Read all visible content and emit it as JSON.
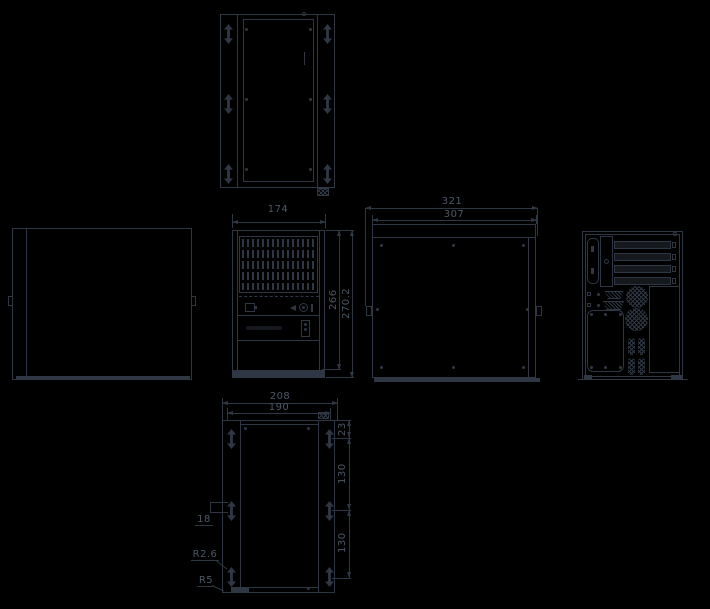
{
  "colors": {
    "background": "#000000",
    "line": "#2e3743",
    "text": "#4d5765"
  },
  "dims": {
    "front_width": "174",
    "front_height": "266",
    "front_height_total": "270.2",
    "depth_total": "321",
    "depth": "307",
    "bottom_width_total": "208",
    "bottom_width": "190",
    "bottom_offset_top": "23",
    "bottom_pitch_upper": "130",
    "bottom_pitch_lower": "130",
    "bottom_slot_width": "18",
    "radius_inner": "R2.6",
    "radius_outer": "R5"
  }
}
